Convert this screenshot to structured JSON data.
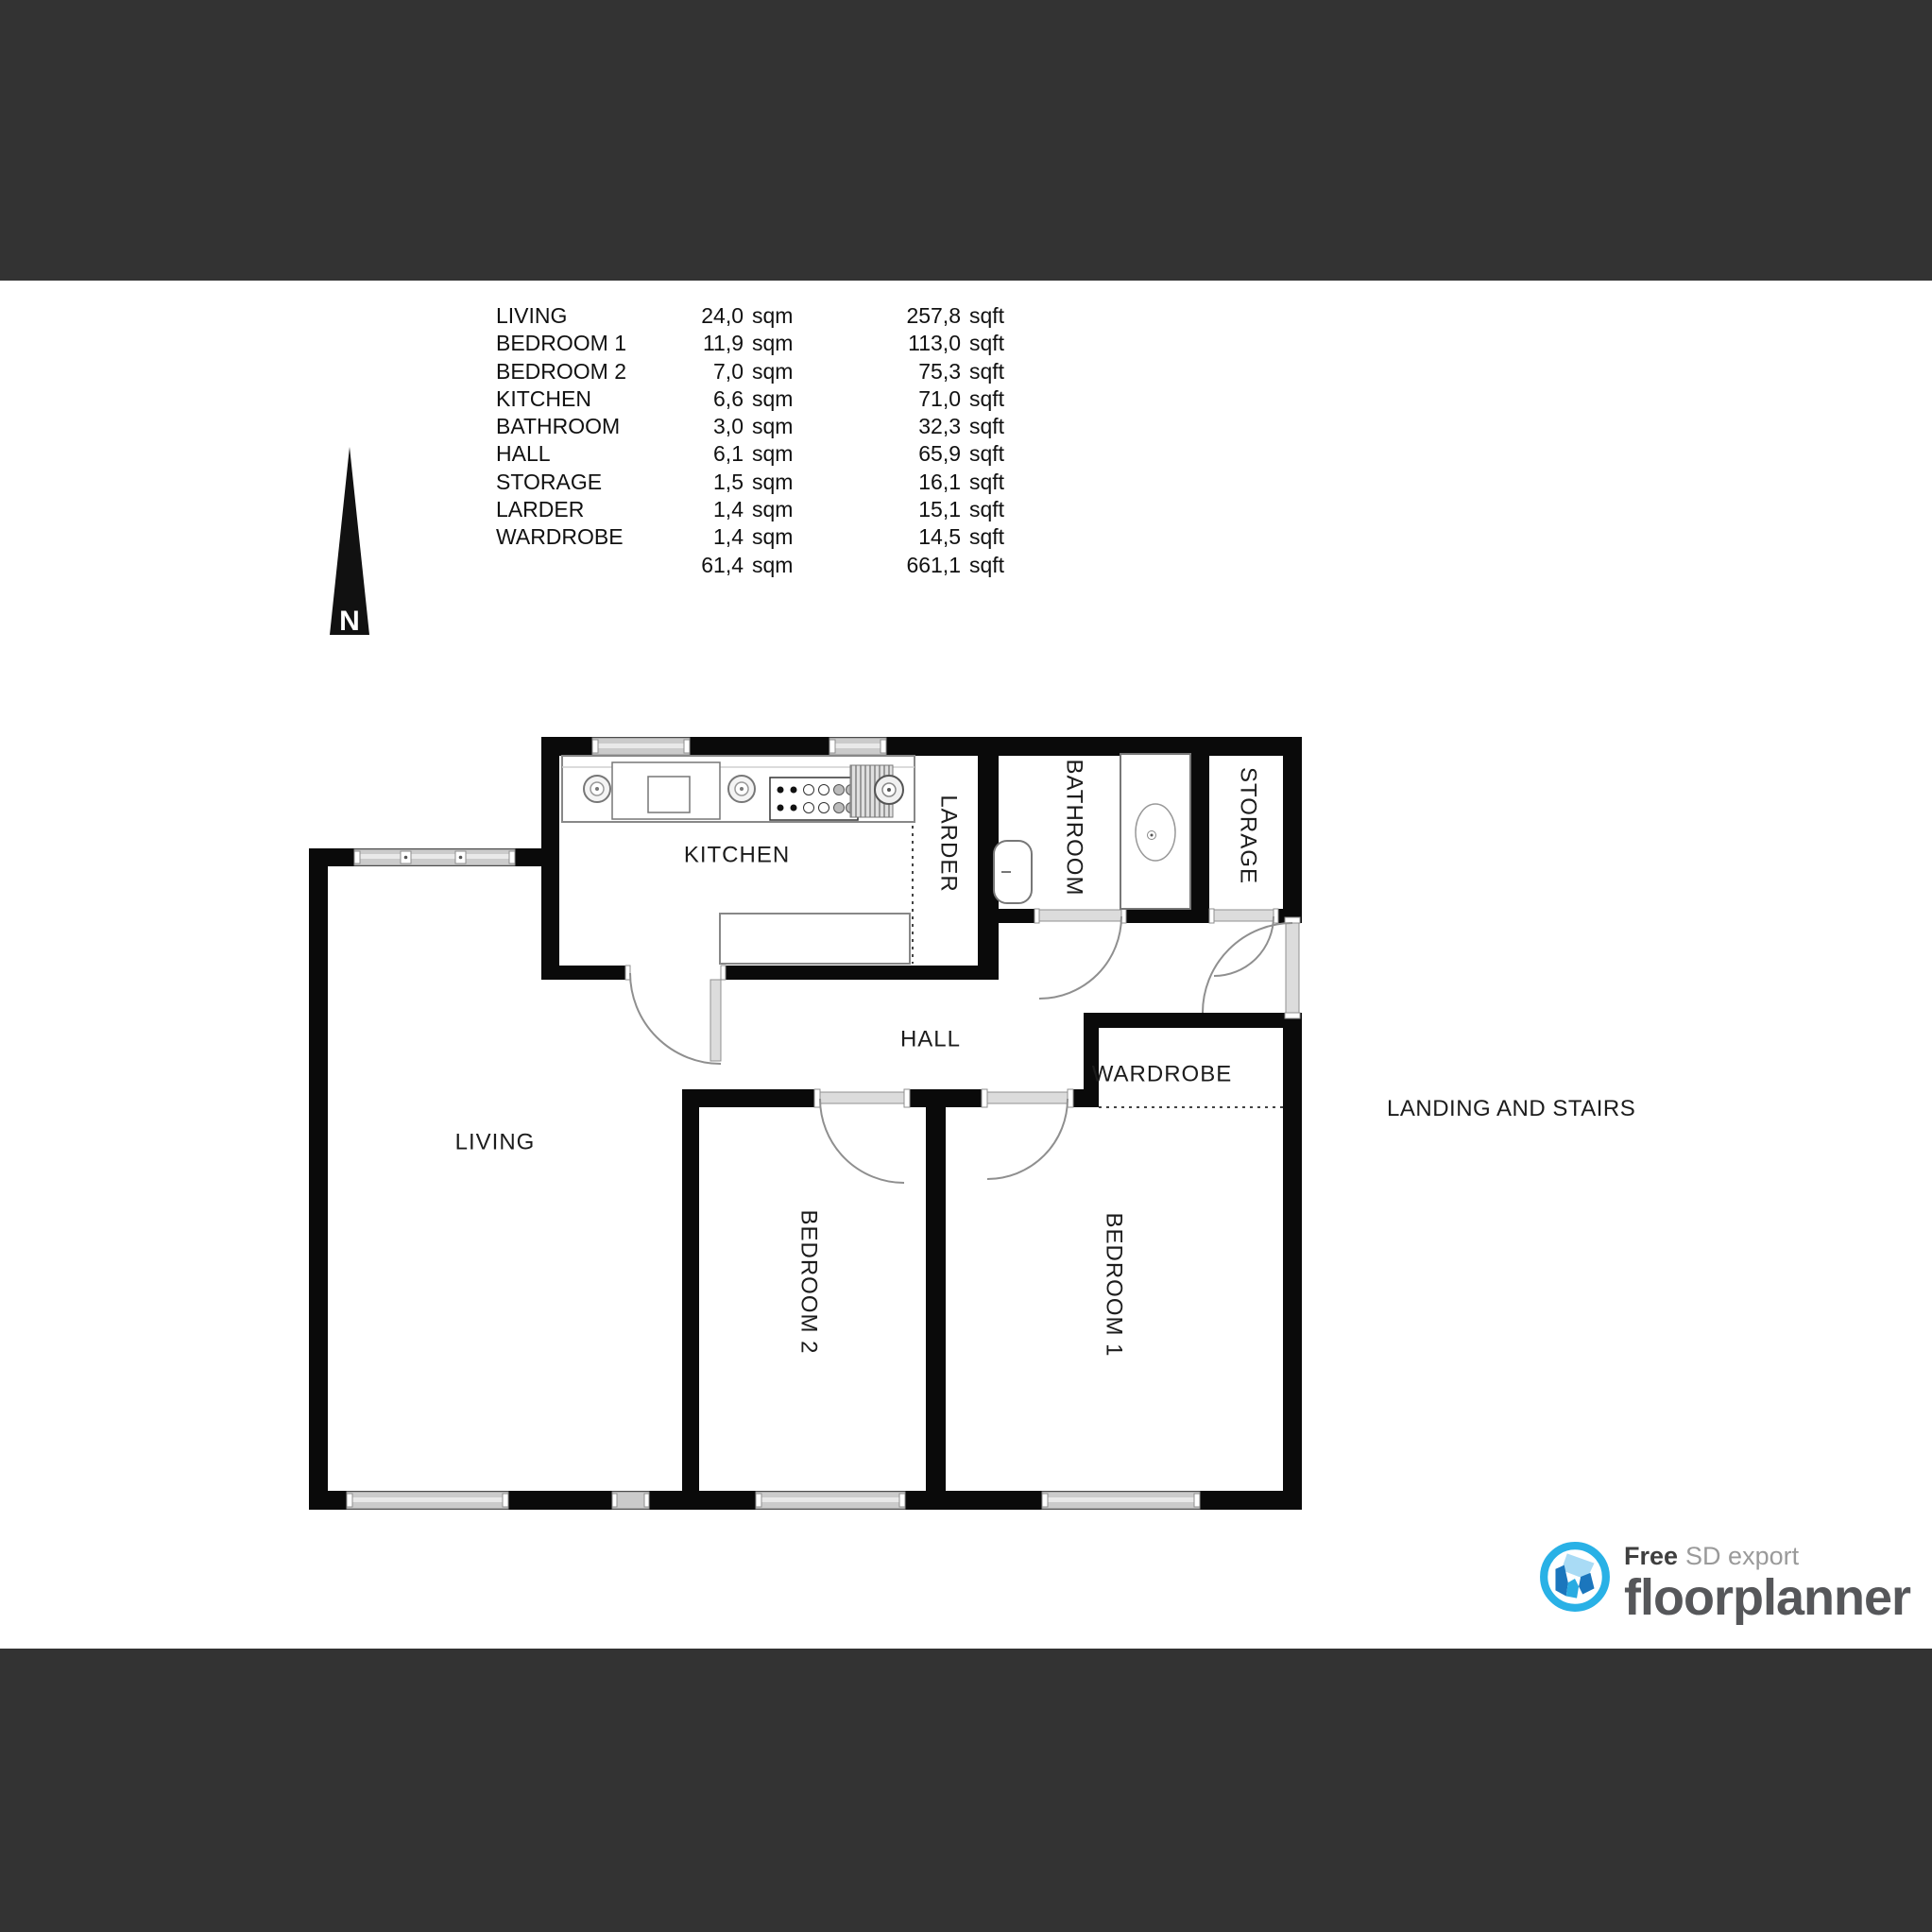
{
  "area_table": {
    "unit_sqm": "sqm",
    "unit_sqft": "sqft",
    "rows": [
      {
        "name": "LIVING",
        "sqm": "24,0",
        "sqft": "257,8"
      },
      {
        "name": "BEDROOM 1",
        "sqm": "11,9",
        "sqft": "113,0"
      },
      {
        "name": "BEDROOM 2",
        "sqm": "7,0",
        "sqft": "75,3"
      },
      {
        "name": "KITCHEN",
        "sqm": "6,6",
        "sqft": "71,0"
      },
      {
        "name": "BATHROOM",
        "sqm": "3,0",
        "sqft": "32,3"
      },
      {
        "name": "HALL",
        "sqm": "6,1",
        "sqft": "65,9"
      },
      {
        "name": "STORAGE",
        "sqm": "1,5",
        "sqft": "16,1"
      },
      {
        "name": "LARDER",
        "sqm": "1,4",
        "sqft": "15,1"
      },
      {
        "name": "WARDROBE",
        "sqm": "1,4",
        "sqft": "14,5"
      }
    ],
    "total": {
      "sqm": "61,4",
      "sqft": "661,1"
    }
  },
  "plan": {
    "north_label": "N",
    "annotation_landing": "LANDING AND STAIRS",
    "rooms": {
      "kitchen": "KITCHEN",
      "larder": "LARDER",
      "bathroom": "BATHROOM",
      "storage": "STORAGE",
      "hall": "HALL",
      "wardrobe": "WARDROBE",
      "living": "LIVING",
      "bedroom2": "BEDROOM 2",
      "bedroom1": "BEDROOM 1"
    }
  },
  "footer": {
    "free": "Free",
    "sd_export": "SD export",
    "brand": "floorplanner"
  },
  "colors": {
    "band": "#333333",
    "wall": "#0a0a0a",
    "brand_blue": "#29abe2",
    "window_gray": "#cbcbcb"
  }
}
